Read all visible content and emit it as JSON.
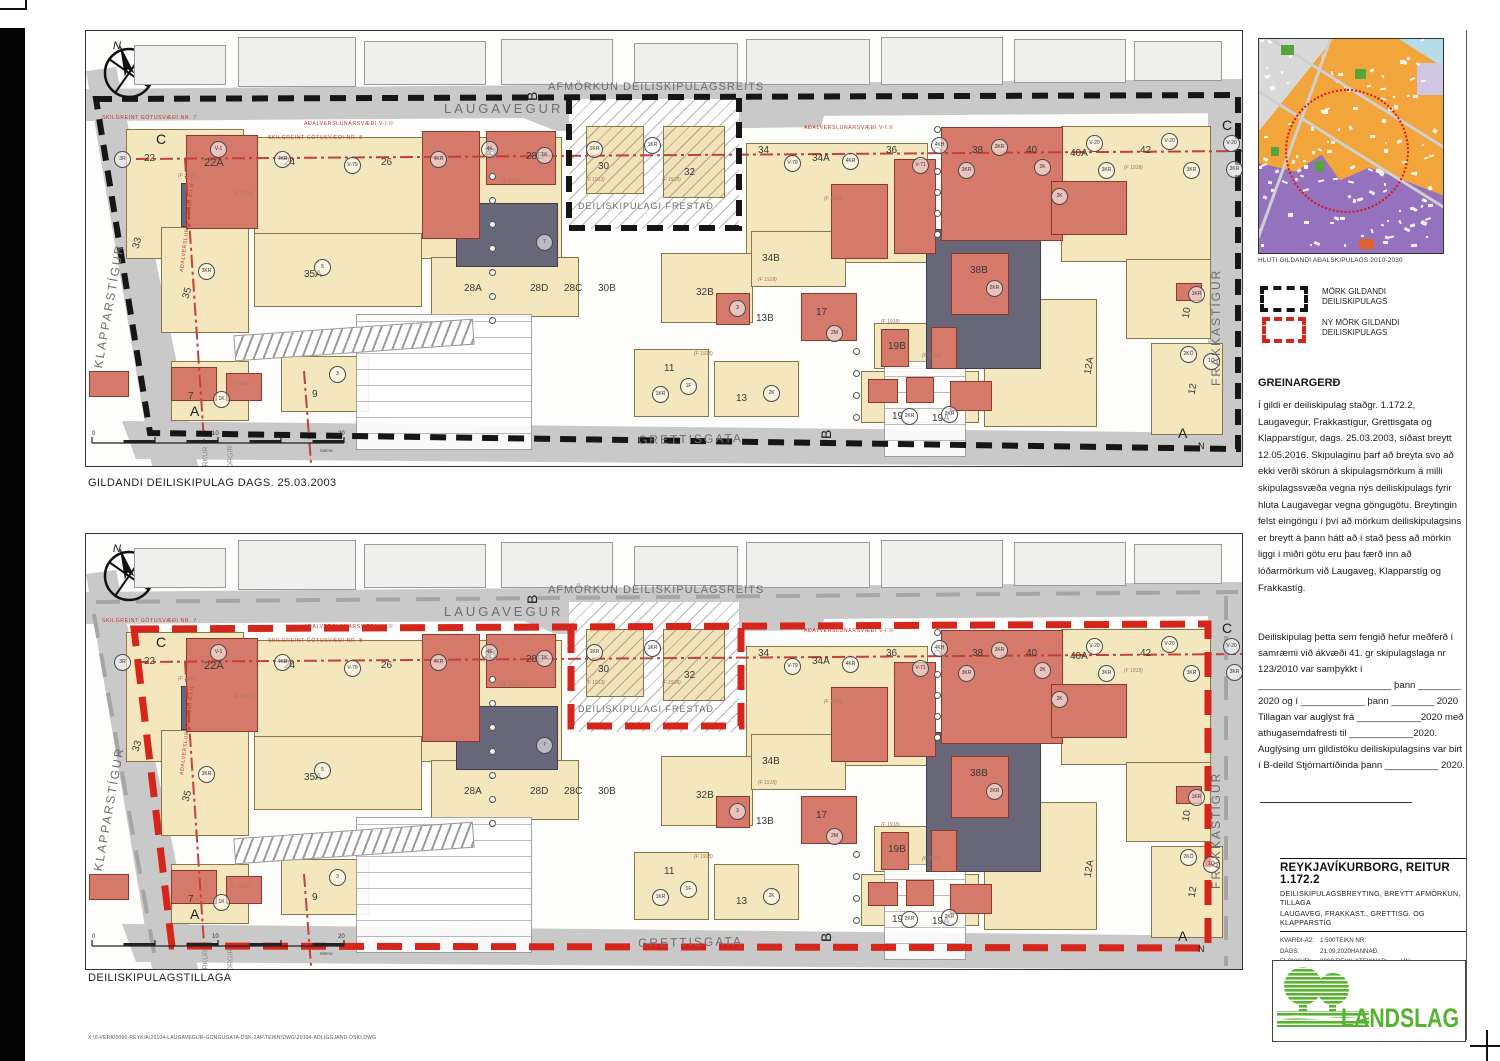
{
  "page": {
    "file_path": "X:\\0-VERK\\0000-REYK\\A\\20104-LAUGAVEGUR-GONGUGATA-DSK-2AF\\TEIKN\\DWG\\20104-ADLIGGJAND-DSKI.DWG"
  },
  "plans": [
    {
      "caption": "GILDANDI DEILISKIPULAG DAGS. 25.03.2003",
      "boundary": {
        "color": "#161616",
        "w": 6,
        "dash": "16 10",
        "poly": "10,68 1152,64 1152,418 64,402",
        "notch": "483,67 483,197 653,197 653,67"
      },
      "centerlines": []
    },
    {
      "caption": "DEILISKIPULAGSTILLAGA",
      "boundary": {
        "color": "#d6251b",
        "w": 7,
        "dash": "25 13",
        "poly": "48,95 1122,90 1122,414 86,412",
        "notch": "485,94 485,192 655,192 655,94"
      },
      "centerlines": [
        "10,68 1152,58",
        "8,80 70,430",
        "1140,62 1140,432"
      ]
    }
  ],
  "plan": {
    "north_label": "N",
    "streets_fill": "#c9c9c9",
    "street_polys": [
      "0,58 1156,48 1156,82 0,90",
      "0,40 30,36 112,435 66,435",
      "1122,62 1156,58 1156,435 1122,435",
      "36,390 1156,402 1156,436 50,428",
      "425,82 740,78 735,96 470,100"
    ],
    "street_names": [
      {
        "t": "LAUGAVEGUR",
        "x": 358,
        "y": 70,
        "s": 13,
        "ls": 3
      },
      {
        "t": "AFMÖRKUN DEILISKIPULAGSREITS",
        "x": 462,
        "y": 50,
        "s": 11,
        "ls": 1
      },
      {
        "t": "GRETTISGATA",
        "x": 552,
        "y": 402,
        "s": 12,
        "ls": 2,
        "r": -1
      },
      {
        "t": "KLAPPARSTÍGUR",
        "x": 12,
        "y": 330,
        "s": 12,
        "ls": 2,
        "r": -80
      },
      {
        "t": "FRAKKASTÍGUR",
        "x": 1130,
        "y": 348,
        "s": 12,
        "ls": 2,
        "r": -90
      },
      {
        "t": "DEILISKIPULAGI FRESTAÐ",
        "x": 492,
        "y": 170,
        "s": 9,
        "ls": 1
      }
    ],
    "red_texts": [
      {
        "t": "SKILGREINT GÖTUSVÆÐI NR. 7",
        "x": 16,
        "y": 84
      },
      {
        "t": "SKILGREINT GÖTUSVÆÐI NR. 8",
        "x": 182,
        "y": 104
      },
      {
        "t": "AÐALVERSLUNARSVÆÐI V-I.II",
        "x": 218,
        "y": 90
      },
      {
        "t": "AÐALVERSLUNARSVÆÐI V-I.II",
        "x": 718,
        "y": 94
      },
      {
        "t": "AÐALVERSLUNARSVÆÐI V-I.II",
        "x": 96,
        "y": 238,
        "r": -83
      }
    ],
    "section_letters": [
      {
        "t": "C",
        "x": 70,
        "y": 100
      },
      {
        "t": "C",
        "x": 1136,
        "y": 86
      },
      {
        "t": "B",
        "x": 446,
        "y": 62,
        "r": -90
      },
      {
        "t": "B",
        "x": 740,
        "y": 400,
        "r": -90
      },
      {
        "t": "A",
        "x": 104,
        "y": 372
      },
      {
        "t": "A",
        "x": 1092,
        "y": 394
      },
      {
        "t": "N",
        "x": 1112,
        "y": 410,
        "s": 9
      }
    ],
    "street_frags": [
      {
        "t": "RKUR",
        "x": 120,
        "y": 432
      },
      {
        "t": "ORGIR",
        "x": 145,
        "y": 434
      }
    ],
    "top_blocks": [
      [
        48,
        14,
        92,
        40
      ],
      [
        152,
        6,
        118,
        50
      ],
      [
        278,
        10,
        122,
        44
      ],
      [
        415,
        8,
        112,
        46
      ],
      [
        548,
        12,
        104,
        40
      ],
      [
        660,
        8,
        124,
        46
      ],
      [
        795,
        6,
        122,
        48
      ],
      [
        928,
        8,
        112,
        44
      ],
      [
        1048,
        10,
        88,
        40
      ]
    ],
    "top_numbers": [
      [
        "31",
        60,
        22
      ],
      [
        "23",
        88,
        22
      ],
      [
        "25",
        165,
        30
      ],
      [
        "27",
        280,
        16
      ],
      [
        "29",
        372,
        20
      ],
      [
        "31",
        458,
        30
      ],
      [
        "33",
        605,
        22
      ],
      [
        "35",
        665,
        26
      ],
      [
        "37",
        758,
        20
      ],
      [
        "39",
        820,
        16
      ],
      [
        "41",
        902,
        13
      ],
      [
        "43",
        1004,
        16
      ],
      [
        "45",
        1058,
        13
      ]
    ],
    "parcels": [
      [
        40,
        98,
        118,
        130
      ],
      [
        168,
        106,
        308,
        122
      ],
      [
        660,
        112,
        182,
        120
      ],
      [
        975,
        95,
        150,
        136
      ],
      [
        75,
        196,
        88,
        106
      ],
      [
        168,
        202,
        168,
        74
      ],
      [
        345,
        226,
        148,
        60
      ],
      [
        575,
        222,
        92,
        70
      ],
      [
        665,
        200,
        95,
        56
      ],
      [
        898,
        268,
        113,
        128
      ],
      [
        1040,
        228,
        85,
        80
      ],
      [
        1065,
        312,
        72,
        92
      ],
      [
        548,
        318,
        75,
        68
      ],
      [
        628,
        330,
        85,
        56
      ],
      [
        195,
        325,
        88,
        56
      ],
      [
        85,
        330,
        78,
        60
      ],
      [
        775,
        340,
        118,
        52
      ],
      [
        788,
        292,
        88,
        46
      ]
    ],
    "darks": [
      [
        370,
        172,
        102,
        64
      ],
      [
        840,
        198,
        115,
        140
      ],
      [
        95,
        152,
        30,
        44
      ]
    ],
    "reds": [
      [
        100,
        104,
        72,
        94
      ],
      [
        336,
        100,
        58,
        108
      ],
      [
        400,
        100,
        70,
        54
      ],
      [
        745,
        153,
        57,
        75
      ],
      [
        808,
        128,
        42,
        95
      ],
      [
        855,
        96,
        122,
        114
      ],
      [
        965,
        150,
        76,
        54
      ],
      [
        715,
        262,
        56,
        48
      ],
      [
        630,
        262,
        34,
        32
      ],
      [
        795,
        298,
        28,
        38
      ],
      [
        845,
        296,
        26,
        42
      ],
      [
        782,
        348,
        30,
        24
      ],
      [
        820,
        346,
        28,
        26
      ],
      [
        864,
        350,
        42,
        30
      ],
      [
        85,
        336,
        46,
        34
      ],
      [
        140,
        342,
        36,
        28
      ],
      [
        3,
        340,
        40,
        26
      ],
      [
        1090,
        252,
        26,
        18
      ],
      [
        865,
        222,
        58,
        62
      ]
    ],
    "hatch_area": {
      "x": 483,
      "y": 68,
      "w": 170,
      "h": 130,
      "buildings": [
        [
          17,
          27,
          58,
          68
        ],
        [
          94,
          27,
          62,
          72
        ]
      ]
    },
    "parking": [
      [
        270,
        283,
        176,
        136
      ],
      [
        798,
        330,
        82,
        96
      ]
    ],
    "chevrons": [
      [
        148,
        296,
        240,
        26
      ]
    ],
    "dot_columns": [
      {
        "x": 403,
        "y": 118,
        "n": 8,
        "dy": 24
      },
      {
        "x": 848,
        "y": 95,
        "n": 6,
        "dy": 21
      },
      {
        "x": 767,
        "y": 317,
        "n": 4,
        "dy": 22
      }
    ],
    "lots": [
      [
        "22",
        58,
        122
      ],
      [
        "22A",
        118,
        126,
        0,
        11
      ],
      [
        "24",
        198,
        126
      ],
      [
        "26",
        295,
        126
      ],
      [
        "28",
        398,
        116
      ],
      [
        "28B",
        440,
        120
      ],
      [
        "30",
        512,
        130
      ],
      [
        "32",
        598,
        136
      ],
      [
        "34",
        672,
        114
      ],
      [
        "34A",
        726,
        122
      ],
      [
        "36",
        800,
        114
      ],
      [
        "38",
        886,
        114
      ],
      [
        "40",
        940,
        114
      ],
      [
        "40A",
        984,
        117
      ],
      [
        "42",
        1054,
        114
      ],
      [
        "33",
        50,
        212,
        -75
      ],
      [
        "35",
        100,
        262,
        -75
      ],
      [
        "35A",
        218,
        238
      ],
      [
        "28A",
        378,
        252
      ],
      [
        "28D",
        444,
        252
      ],
      [
        "28C",
        478,
        252
      ],
      [
        "30B",
        512,
        252
      ],
      [
        "32B",
        610,
        256
      ],
      [
        "34B",
        676,
        222
      ],
      [
        "13B",
        670,
        282
      ],
      [
        "17",
        730,
        276
      ],
      [
        "19B",
        802,
        310
      ],
      [
        "38B",
        884,
        234
      ],
      [
        "12A",
        1002,
        338,
        -80
      ],
      [
        "10",
        1100,
        282,
        -80
      ],
      [
        "12",
        1106,
        358,
        -80
      ],
      [
        "11",
        578,
        332
      ],
      [
        "13",
        650,
        362
      ],
      [
        "7",
        102,
        360
      ],
      [
        "9",
        226,
        358
      ],
      [
        "19",
        806,
        380
      ],
      [
        "19A",
        846,
        382
      ]
    ],
    "badges": [
      [
        "3R",
        28,
        120
      ],
      [
        "V-1",
        124,
        110
      ],
      [
        "4KR",
        188,
        120
      ],
      [
        "V-79",
        258,
        126
      ],
      [
        "4KR",
        344,
        120
      ],
      [
        "4K",
        395,
        110
      ],
      [
        "1K",
        450,
        116
      ],
      [
        "1KR",
        500,
        110
      ],
      [
        "1KR",
        558,
        106
      ],
      [
        "V-79",
        698,
        124
      ],
      [
        "4KR",
        756,
        122
      ],
      [
        "V-71",
        826,
        126
      ],
      [
        "4KH",
        845,
        106
      ],
      [
        "3KR",
        872,
        131
      ],
      [
        "3KR",
        905,
        108
      ],
      [
        "2K",
        948,
        128
      ],
      [
        "V-20",
        1000,
        104
      ],
      [
        "3KR",
        1012,
        131
      ],
      [
        "V-20",
        1075,
        102
      ],
      [
        "3KR",
        1097,
        131
      ],
      [
        "V-20",
        1137,
        104
      ],
      [
        "3KR",
        1140,
        130
      ],
      [
        "3KR",
        112,
        232
      ],
      [
        "5",
        228,
        228
      ],
      [
        "7",
        450,
        203
      ],
      [
        "3",
        243,
        335
      ],
      [
        "1KR",
        566,
        355
      ],
      [
        "1F",
        594,
        347
      ],
      [
        "2K",
        677,
        354
      ],
      [
        "1K",
        127,
        360
      ],
      [
        "2M",
        740,
        294
      ],
      [
        "3",
        643,
        269
      ],
      [
        "2KR",
        815,
        377
      ],
      [
        "2KR",
        855,
        375
      ],
      [
        "2KR",
        900,
        249
      ],
      [
        "2K",
        965,
        157
      ],
      [
        "1KR",
        1102,
        255
      ],
      [
        "2KÖ",
        1094,
        315
      ],
      [
        "1Ö",
        1117,
        322
      ]
    ],
    "notes": [
      [
        "(F 1918)",
        92,
        142
      ],
      [
        "(F 1913)",
        148,
        160
      ],
      [
        "(F 1918)",
        416,
        148
      ],
      [
        "(F 1913)",
        500,
        146
      ],
      [
        "(F 1918)",
        576,
        146
      ],
      [
        "(F 1918)",
        1038,
        134
      ],
      [
        "(F 1918)",
        672,
        246
      ],
      [
        "(F 1918)",
        608,
        320
      ],
      [
        "(F 1918)",
        795,
        288
      ],
      [
        "(F 1918)",
        836,
        322
      ],
      [
        "(F 1918)",
        145,
        350
      ],
      [
        "(F 1918)",
        738,
        165
      ]
    ],
    "scalebar": {
      "labels": [
        "0",
        "10",
        "20"
      ],
      "unit": "Metrar"
    }
  },
  "sidebar": {
    "inset_caption": "HLUTI GILDANDI AÐALSKIPULAGS 2010-2030",
    "legend": [
      {
        "color": "#141414",
        "line1": "MÖRK GILDANDI",
        "line2": "DEILISKIPULAGS"
      },
      {
        "color": "#d6251b",
        "line1": "NÝ MÖRK GILDANDI",
        "line2": "DEILISKIPULAGS"
      }
    ],
    "greinargerd_title": "GREINARGERÐ",
    "greinargerd_lines": [
      "Í gildi er deiliskipulag staðgr. 1.172.2,",
      "Laugavegur, Frakkastígur, Grettisgata og",
      "Klapparstígur, dags. 25.03.2003, síðast breytt",
      "12.05.2016. Skipulaginu þarf að breyta svo að",
      "ekki verði skörun á skipulagsmörkum á milli",
      "skipulagssvæða vegna nýs deiliskipulags fyrir",
      "hluta Laugavegar vegna göngugötu. Breytingin",
      "felst eingöngu í því að mörkum deiliskipulagsins",
      "er breytt á þann hátt að í stað þess að mörkin",
      "liggi í miðri götu eru þau færð inn að",
      "lóðarmörkum við Laugaveg, Klapparstíg og",
      "Frakkastíg."
    ],
    "approval_lines": [
      "Deiliskipulag þetta sem fengið hefur meðferð í",
      "samræmi við ákvæði 41. gr skipulagslaga nr",
      "123/2010 var samþykkt í",
      "_________________________ þann ________",
      "2020 og í ____________ þann ________ 2020",
      "Tillagan var auglýst frá ____________2020 með",
      "athugasemdafresti til ____________2020.",
      "Auglýsing um gildistöku deiliskipulagsins var birt",
      "í B-deild Stjórnartíðinda þann __________ 2020."
    ],
    "titleblock": {
      "title": "REYKJAVÍKURBORG, REITUR 1.172.2",
      "subtitle1": "DEILISKIPULAGSBREYTING, BREYTT AFMÖRKUN, TILLAGA",
      "subtitle2": "LAUGAVEG, FRAKKAST., GRETTISG. OG KLAPPARSTÍG",
      "rows": [
        {
          "l1": "KVARÐI-A2:",
          "v1": "1:500",
          "l2": "TEIKN NR:",
          "v2": ""
        },
        {
          "l1": "DAGS:",
          "v1": "21.09.2020",
          "l2": "HANNAÐ:",
          "v2": ""
        },
        {
          "l1": "FLOKKUR:",
          "v1": "0000-REYK-A",
          "l2": "TEIKNAÐ:",
          "v2": "HN"
        },
        {
          "l1": "SKRÁ:",
          "v1": "20104-adliggjand.dski.dwg",
          "l2": "VERKNR:",
          "v2": "20104"
        }
      ]
    },
    "logo_text": "LANDSLAG",
    "logo_green": "#55b32e"
  }
}
